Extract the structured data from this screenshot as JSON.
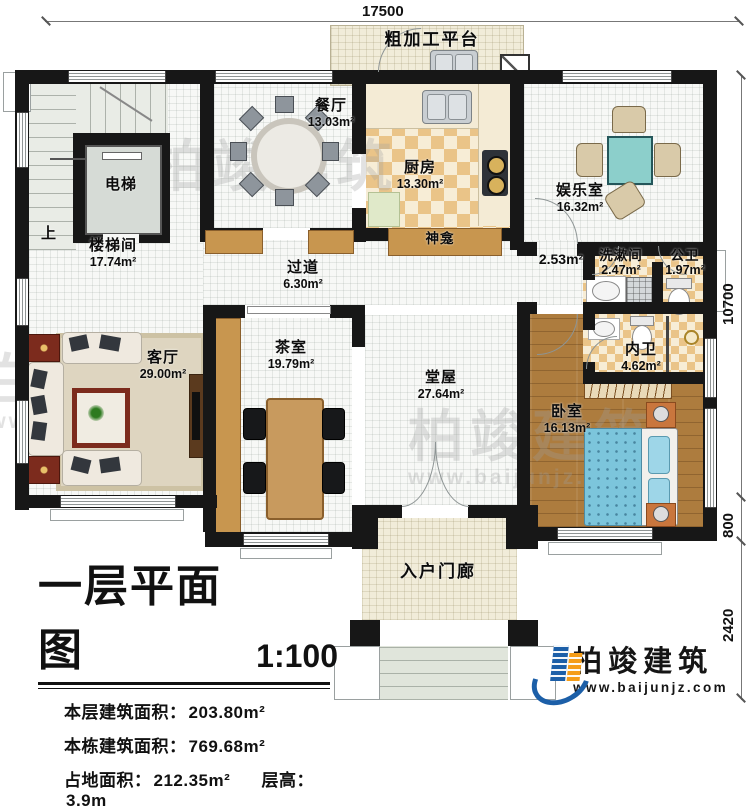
{
  "plan": {
    "rooms": {
      "stairwell": {
        "name": "楼梯间",
        "area": "17.74m²"
      },
      "up_mark": {
        "name": "上"
      },
      "elevator": {
        "name": "电梯"
      },
      "dining": {
        "name": "餐厅",
        "area": "13.03m²"
      },
      "kitchen": {
        "name": "厨房",
        "area": "13.30m²"
      },
      "platform": {
        "name": "粗加工平台"
      },
      "entertainment": {
        "name": "娱乐室",
        "area": "16.32m²"
      },
      "shrine": {
        "name": "神龛"
      },
      "hallway": {
        "name": "过道",
        "area": "6.30m²"
      },
      "corridor": {
        "area": "2.53m²"
      },
      "washroom": {
        "name": "洗漱间",
        "area": "2.47m²"
      },
      "public_wc": {
        "name": "公卫",
        "area": "1.97m²"
      },
      "ensuite_wc": {
        "name": "内卫",
        "area": "4.62m²"
      },
      "living": {
        "name": "客厅",
        "area": "29.00m²"
      },
      "tea_room": {
        "name": "茶室",
        "area": "19.79m²"
      },
      "main_hall": {
        "name": "堂屋",
        "area": "27.64m²"
      },
      "bedroom": {
        "name": "卧室",
        "area": "16.13m²"
      },
      "porch": {
        "name": "入户门廊"
      }
    },
    "dimensions": {
      "top": "17500",
      "right_upper": "10700",
      "right_middle": "800",
      "right_lower": "2420"
    }
  },
  "title_block": {
    "title": "一层平面图",
    "scale": "1:100",
    "stats": {
      "l1_label": "本层建筑面积：",
      "l1_value": "203.80m²",
      "l2_label": "本栋建筑面积：",
      "l2_value": "769.68m²",
      "l3a_label": "占地面积：",
      "l3a_value": "212.35m²",
      "l3b_label": "层高：",
      "l3b_value": "3.9m"
    }
  },
  "logo": {
    "company": "柏竣建筑",
    "website": "www.baijunjz.com"
  },
  "watermark": {
    "company": "柏竣建筑",
    "website": "www.baijunjz.com"
  },
  "colors": {
    "wall": "#171717",
    "kitchen_tile": "#eac488",
    "wood_floor": "#ad7c3e",
    "bed_blue": "#7cc5dc",
    "game_table": "#8ccfcb",
    "logo_blue": "#1c5fa8",
    "logo_orange": "#f59d18"
  }
}
